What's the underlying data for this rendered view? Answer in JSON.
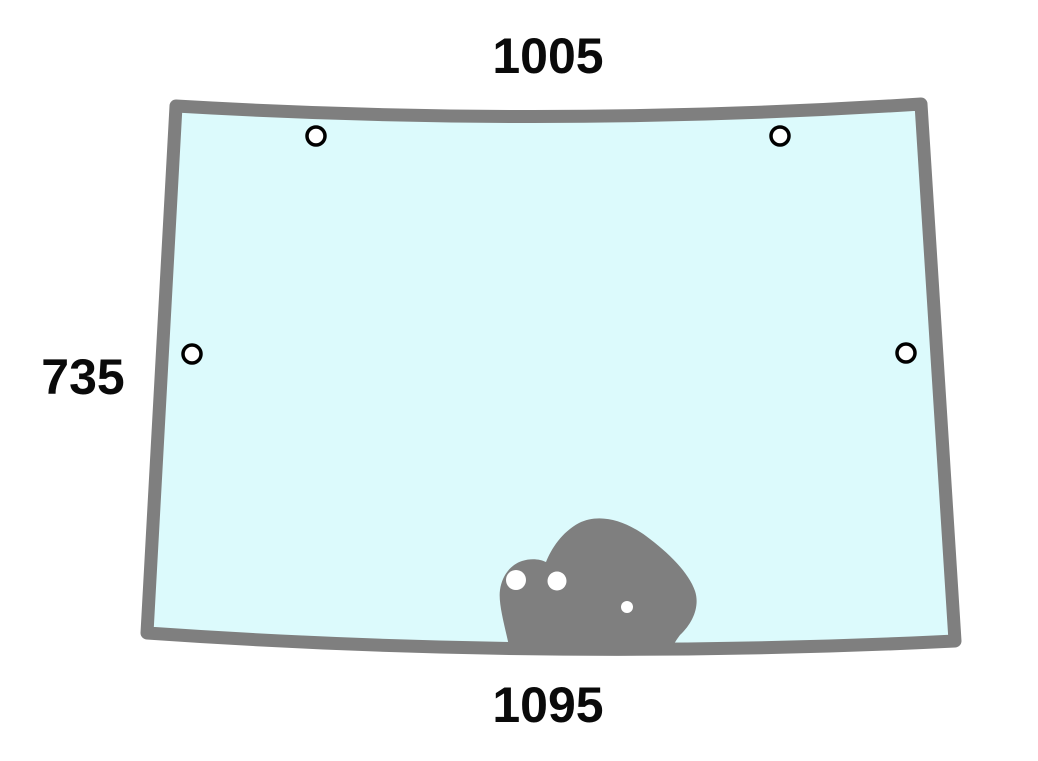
{
  "diagram": {
    "labels": {
      "top_width": "1005",
      "left_height": "735",
      "bottom_width": "1095"
    },
    "features": {
      "corner_hole_count": 4,
      "bracket_hole_count": 3
    },
    "colors": {
      "frame_gray": "#7f7f7f",
      "glass_tint": "#dcfafc",
      "hole_fill": "#ffffff",
      "hole_ring": "#000000",
      "label_text": "#0a0a0a",
      "background": "#ffffff"
    }
  }
}
